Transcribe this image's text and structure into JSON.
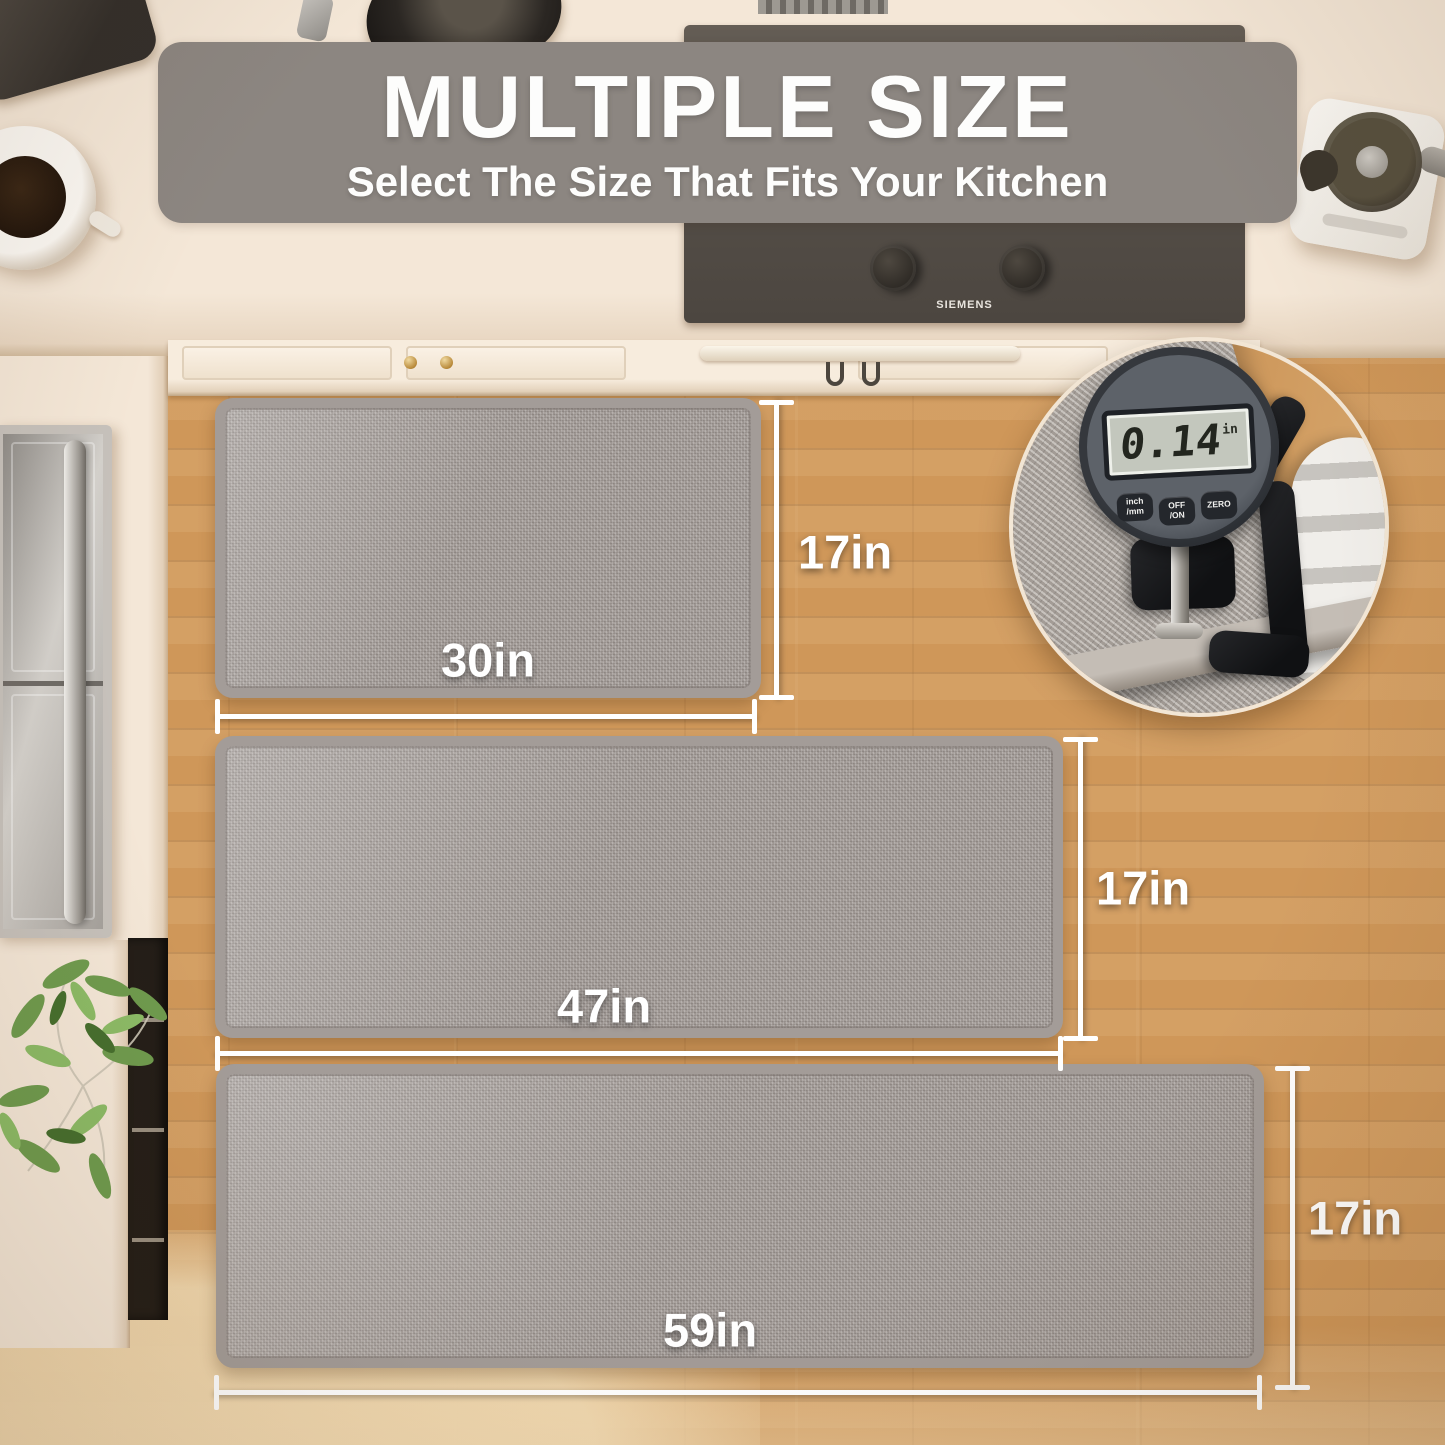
{
  "banner": {
    "title": "MULTIPLE SIZE",
    "subtitle": "Select The Size That Fits Your Kitchen",
    "bg_color": "#8c8681"
  },
  "mats": [
    {
      "id": "mat-30x17",
      "width_label": "30in",
      "height_label": "17in"
    },
    {
      "id": "mat-47x17",
      "width_label": "47in",
      "height_label": "17in"
    },
    {
      "id": "mat-59x17",
      "width_label": "59in",
      "height_label": "17in"
    }
  ],
  "thickness_inset": {
    "display_value": "0.14",
    "display_unit": "in",
    "buttons": [
      {
        "line1": "inch",
        "line2": "/mm"
      },
      {
        "line1": "OFF",
        "line2": "/ON"
      },
      {
        "line1": "ZERO",
        "line2": ""
      }
    ]
  },
  "appliances": {
    "cooktop_brand": "SIEMENS"
  },
  "colors": {
    "floor": "#cf9759",
    "floor_light": "#f0d8af",
    "counter": "#f4e7d7",
    "mat": "#a49d99",
    "banner": "#8c8681",
    "dimension_line": "#ffffff",
    "cooktop": "#57514a"
  }
}
